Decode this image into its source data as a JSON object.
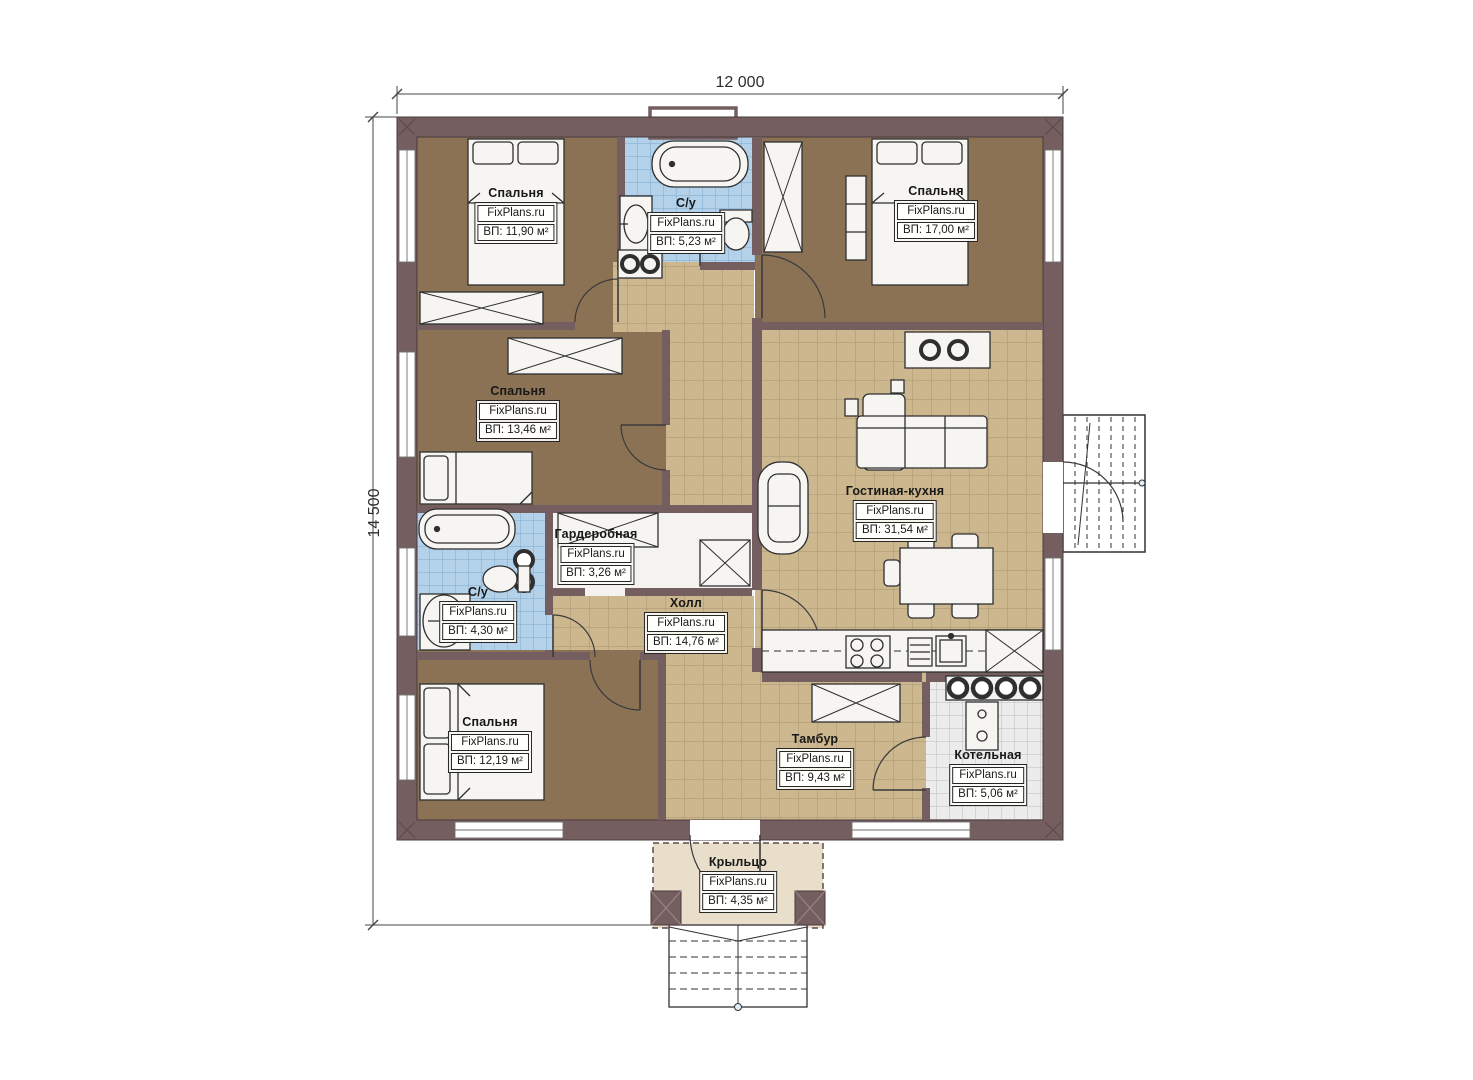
{
  "plan": {
    "brand": "FixPlans.ru",
    "dimensions": {
      "width_label": "12 000",
      "height_label": "14 500"
    },
    "rooms": [
      {
        "id": "bedroom-1",
        "name": "Спальня",
        "site": "FixPlans.ru",
        "area": "ВП: 11,90 м²"
      },
      {
        "id": "bathroom-top",
        "name": "С/у",
        "site": "FixPlans.ru",
        "area": "ВП: 5,23 м²"
      },
      {
        "id": "bedroom-2",
        "name": "Спальня",
        "site": "FixPlans.ru",
        "area": "ВП: 17,00 м²"
      },
      {
        "id": "bedroom-3",
        "name": "Спальня",
        "site": "FixPlans.ru",
        "area": "ВП: 13,46 м²"
      },
      {
        "id": "living-kitchen",
        "name": "Гостиная-кухня",
        "site": "FixPlans.ru",
        "area": "ВП: 31,54 м²"
      },
      {
        "id": "wardrobe",
        "name": "Гардеробная",
        "site": "FixPlans.ru",
        "area": "ВП: 3,26 м²"
      },
      {
        "id": "bathroom-left",
        "name": "С/у",
        "site": "FixPlans.ru",
        "area": "ВП: 4,30 м²"
      },
      {
        "id": "hall",
        "name": "Холл",
        "site": "FixPlans.ru",
        "area": "ВП: 14,76 м²"
      },
      {
        "id": "bedroom-4",
        "name": "Спальня",
        "site": "FixPlans.ru",
        "area": "ВП: 12,19 м²"
      },
      {
        "id": "vestibule",
        "name": "Тамбур",
        "site": "FixPlans.ru",
        "area": "ВП: 9,43 м²"
      },
      {
        "id": "boiler-room",
        "name": "Котельная",
        "site": "FixPlans.ru",
        "area": "ВП: 5,06 м²"
      },
      {
        "id": "porch",
        "name": "Крыльцо",
        "site": "FixPlans.ru",
        "area": "ВП: 4,35 м²"
      }
    ],
    "colors": {
      "wall": "#745e60",
      "bedroom_floor": "#8b7255",
      "tile_floor": "#cdb78f",
      "tile_grid": "#a5946e",
      "bath_tile": "#b3d2ea",
      "bath_grid": "#7fa9cc",
      "boiler_tile": "#ececec",
      "boiler_grid": "#bdbdbd",
      "porch_floor": "#e8deca",
      "paper": "#ffffff"
    }
  }
}
